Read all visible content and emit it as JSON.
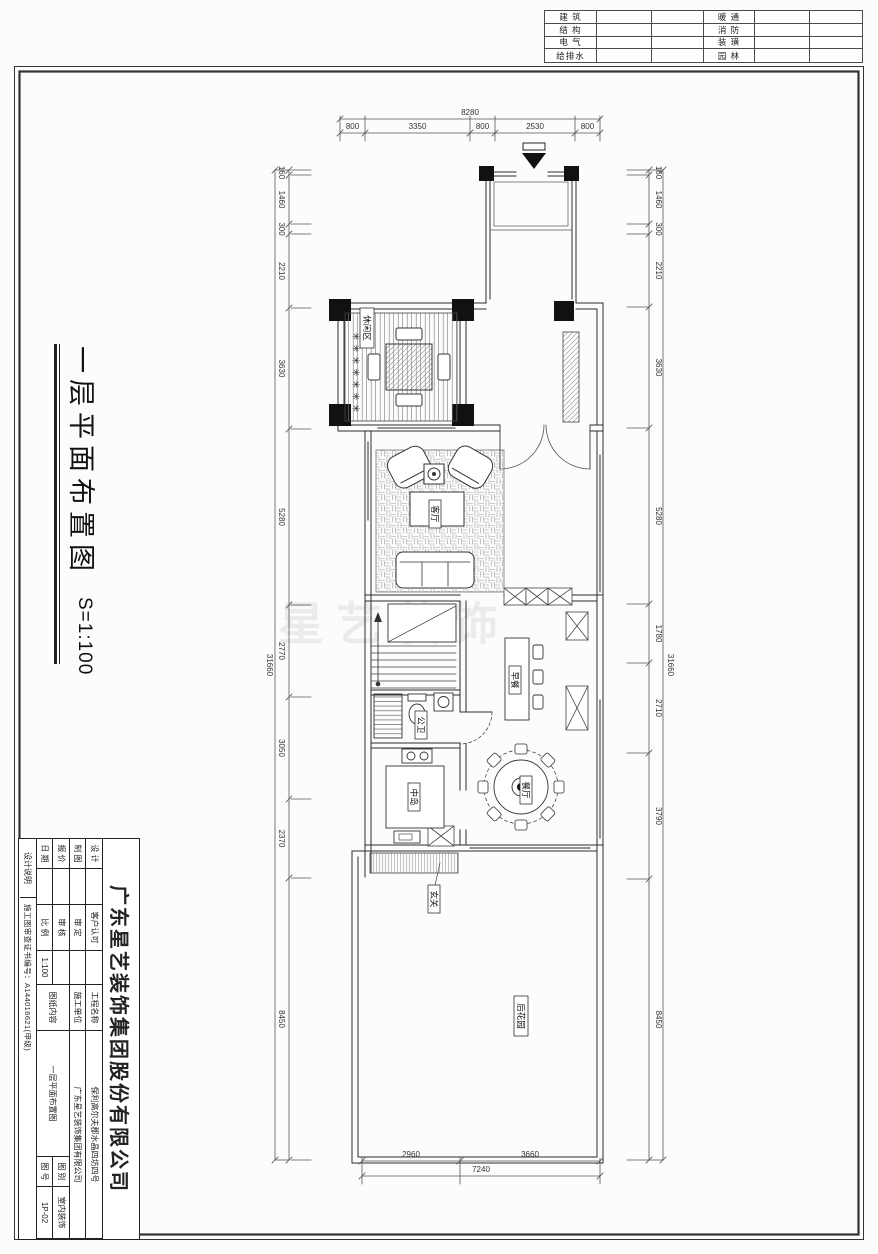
{
  "sheet": {
    "watermark": "星艺装饰",
    "disciplines": {
      "left": [
        "建 筑",
        "结 构",
        "电 气",
        "给排水"
      ],
      "right": [
        "暖 通",
        "消 防",
        "装 璜",
        "园 林"
      ]
    },
    "side_title": {
      "title": "一层平面布置图",
      "scale": "S=1:100"
    }
  },
  "plan": {
    "symbols": {
      "plant": "✳"
    },
    "rooms": {
      "leisure": "休闲区",
      "living": "客厅",
      "breakfast": "早餐",
      "powder": "公卫",
      "island": "中岛",
      "dining": "餐厅",
      "foyer": "玄关",
      "garden": "后花园"
    },
    "dims": {
      "top": {
        "total": "8280",
        "segments": [
          "800",
          "3350",
          "800",
          "2530",
          "800"
        ]
      },
      "bottom": {
        "total": "7240",
        "segments": [
          "2960",
          "3660"
        ]
      },
      "left": {
        "total": "31660",
        "segments": [
          "160",
          "1460",
          "300",
          "2210",
          "3630",
          "5280",
          "2770",
          "3050",
          "2370",
          "8450"
        ]
      },
      "right": {
        "total": "31660",
        "segments": [
          "160",
          "1460",
          "300",
          "2210",
          "3630",
          "5280",
          "1780",
          "2710",
          "3790",
          "8450"
        ]
      }
    }
  },
  "title_block": {
    "company": "广东星艺装饰集团股份有限公司",
    "rows": {
      "design": "设 计",
      "draft": "制 图",
      "quote": "报 价",
      "date": "日 期",
      "client": "客户认可",
      "approved": "审 定",
      "checked": "审 核",
      "scale_label": "比 例",
      "scale_value": "1:100",
      "project_label": "工程名称",
      "project": "保利高尔夫郡水晶四坊四号",
      "builder_label": "施工单位",
      "builder": "广东星艺装饰集团有限公司",
      "content_label": "图纸内容",
      "content": "一层平面布置图",
      "category_label": "图 别",
      "category": "室内装饰",
      "no_label": "图 号",
      "no": "1P-02"
    },
    "notes": "设计说明",
    "certificate": "施工图审查证书编号：A144016621(甲级)"
  }
}
